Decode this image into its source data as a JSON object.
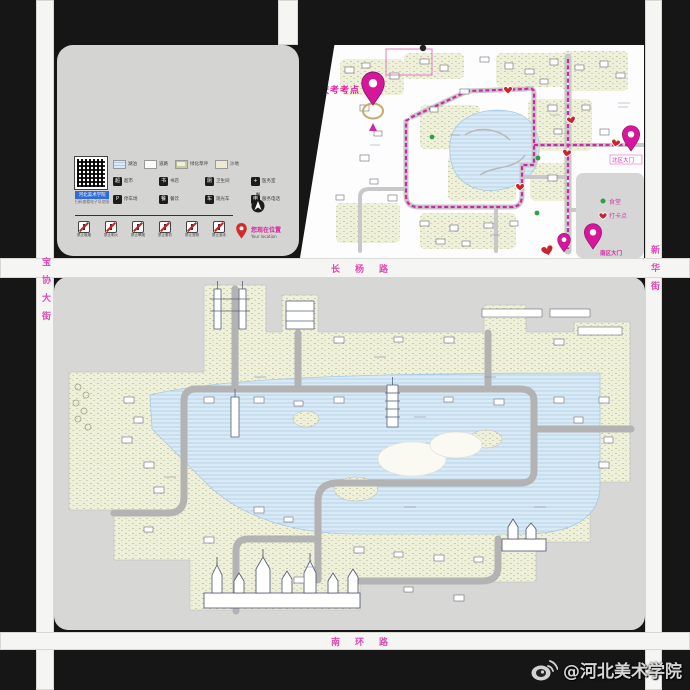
{
  "roads": {
    "mid_label": "长杨路",
    "bottom_label": "南环路",
    "left_label": "宝协大街",
    "right_label": "新华街"
  },
  "legend": {
    "qr_caption": "河北美术学院",
    "qr_sub": "扫码查看电子导览图",
    "compass_label": "N",
    "location_label": "您现在位置",
    "location_sub": "Your location",
    "area_items": [
      {
        "label": "湖泊"
      },
      {
        "label": "道路"
      },
      {
        "label": "绿化草坪"
      },
      {
        "label": "沙地"
      }
    ],
    "facility_items": [
      {
        "glyph": "超",
        "label": "超市"
      },
      {
        "glyph": "书",
        "label": "书店"
      },
      {
        "glyph": "厕",
        "label": "卫生间"
      },
      {
        "glyph": "+",
        "label": "医务室"
      },
      {
        "glyph": "P",
        "label": "停车场"
      },
      {
        "glyph": "餐",
        "label": "餐饮"
      },
      {
        "glyph": "车",
        "label": "观光车"
      },
      {
        "glyph": "电",
        "label": "服务电话"
      }
    ],
    "warning_items": [
      {
        "label": "禁止吸烟"
      },
      {
        "label": "禁止明火"
      },
      {
        "label": "禁止攀爬"
      },
      {
        "label": "禁止垂钓"
      },
      {
        "label": "禁止宠物"
      },
      {
        "label": "禁止游泳"
      }
    ]
  },
  "north_map": {
    "exam_label": "校考考点",
    "gate_right_label": "北区大门",
    "gate_bottom_label": "南区大门",
    "mini_legend": {
      "dot_label": "食堂",
      "heart_label": "打卡点"
    }
  },
  "watermark": {
    "handle": "@河北美术学院"
  },
  "colors": {
    "route_magenta": "#cf28a5",
    "heart_red": "#c9262c",
    "dot_green": "#2f9e44",
    "pink_text": "#e04ab4",
    "water": "#d9eaf6",
    "grass": "#eef0da"
  }
}
